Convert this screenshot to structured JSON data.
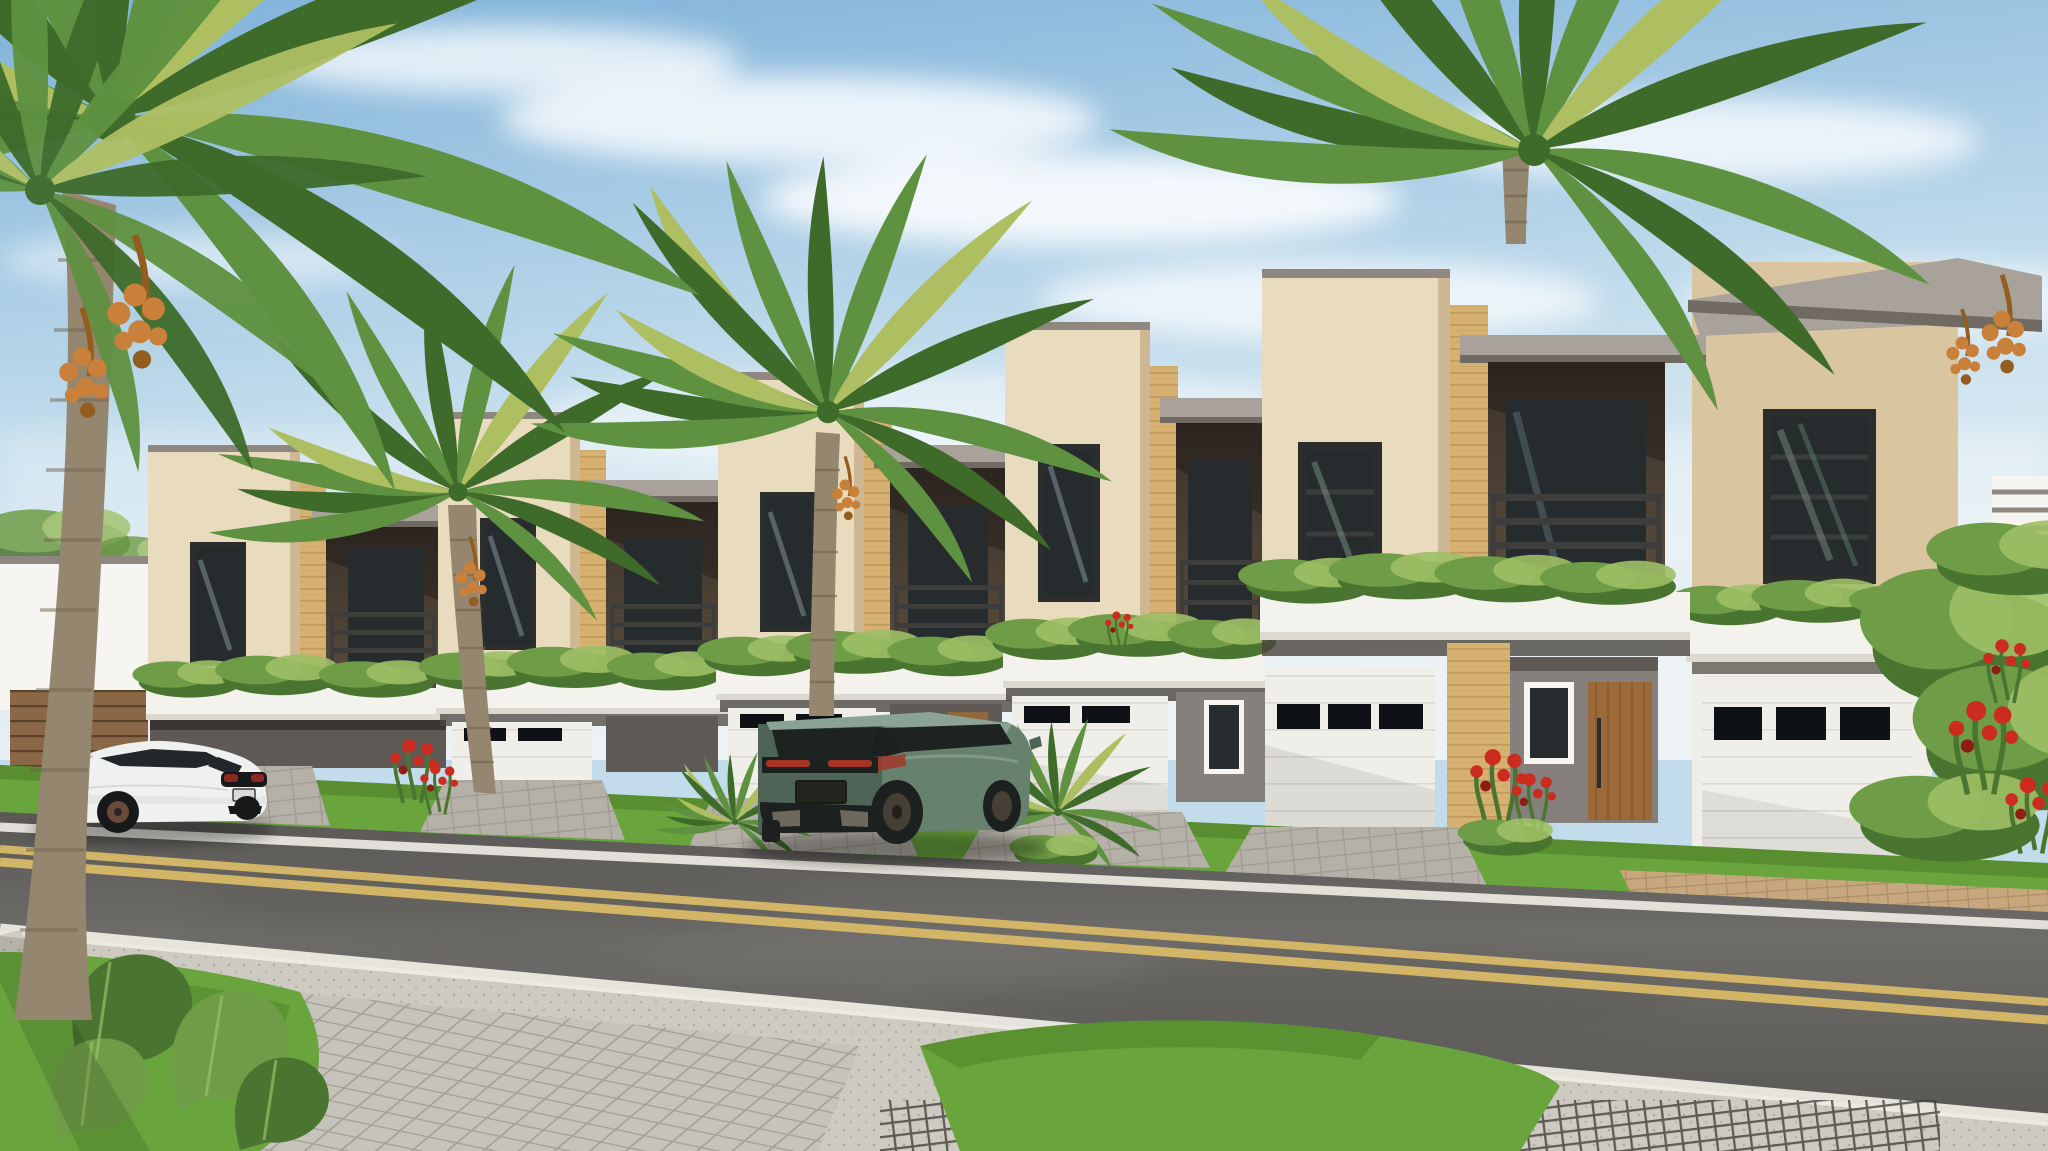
{
  "meta": {
    "kind": "architectural-rendering",
    "width_px": 2048,
    "height_px": 1151
  },
  "scene": {
    "setting": "Sunny street-level rendering of a row of modern two-story townhomes with palm trees",
    "sky": {
      "condition": "blue with wispy clouds"
    },
    "buildings": {
      "type": "modern townhomes",
      "stories": 2,
      "visible_units": 6,
      "features": [
        "flat parapet roofs with gray copings",
        "recessed balconies with dark metal railings",
        "white planter ledges with trailing plants",
        "wood-plank accent pilasters",
        "white sectional garage doors with black window slits",
        "recessed entries with wood doors",
        "front lawns and paver driveways"
      ]
    },
    "vehicles": [
      {
        "name": "white-sedan",
        "body_color_name": "white",
        "pose": "parked on street, rear three-quarter view"
      },
      {
        "name": "green-suv",
        "body_color_name": "sage green",
        "pose": "parked on driveway, rear three-quarter view"
      }
    ],
    "vegetation": [
      "date palms with orange fruit clusters",
      "balcony planter shrubs",
      "lawn strips",
      "monstera foreground plant",
      "red flowering shrubs",
      "right-side hedge with red blooms"
    ],
    "street": {
      "surface": "asphalt",
      "markings": [
        "double yellow center line",
        "white edge lines"
      ],
      "foreground": [
        "square paver sidewalk",
        "speckled concrete walk",
        "dark grid pavers",
        "grass mounds"
      ]
    }
  },
  "palette": {
    "sky_top": "#7fb2d9",
    "sky_mid": "#c2dcec",
    "sky_horizon": "#edf3f5",
    "cloud": "#ffffff",
    "wall": "#e9dbbd",
    "wall_shade": "#d9c6a1",
    "wall_dark": "#c0aa82",
    "cap": "#a8a29a",
    "cap_shade": "#8e8880",
    "cap_dark": "#6f6a62",
    "recess": "#5a4c3d",
    "recess_dark": "#3b322a",
    "glass": "#262c2e",
    "frame": "#2c2e2d",
    "railing": "#3d3d3b",
    "wood": "#d7b171",
    "wood_dark": "#af8848",
    "band": "#f4f2ec",
    "band_shade": "#ddd9d0",
    "soffit": "#4a453f",
    "plant": "#6f9c47",
    "plant_hi": "#9dc065",
    "plant_dark": "#4a7531",
    "garage": "#f0eee8",
    "garage_shade": "#d9d6cf",
    "slit": "#0e1216",
    "entry": "#85807b",
    "entry_dark": "#5f5a55",
    "door_wood": "#9c6a38",
    "door_wood_dark": "#6f4820",
    "white_trim": "#f6f5f1",
    "grass": "#69a43d",
    "grass_dark": "#4c8028",
    "drive": "#b5b1a8",
    "drive_dark": "#8f8a80",
    "drive_tan": "#c7a87e",
    "road": "#6e6c69",
    "road_dark": "#5a5855",
    "line_yellow": "#d2b567",
    "line_white": "#eeebe3",
    "walk": "#cdcac1",
    "walk_dot": "#aeaba2",
    "mesh": "#3b3934",
    "trunk": "#95866f",
    "trunk_dark": "#6e604d",
    "frond": "#5e9140",
    "frond_dark": "#3e6b2a",
    "frond_yellow": "#aebf62",
    "dates": "#c8803a",
    "dates_dark": "#935d20",
    "flower": "#cc2b20",
    "flower_dark": "#8e1d14",
    "hedge": "#567f36",
    "hedge_dark": "#3b6123",
    "car_body": "#eff1f1",
    "car_shade": "#c9cbcb",
    "car_glass": "#22272c",
    "car_trim": "#16181a",
    "car_red": "#8c2a22",
    "car_rim": "#6b4a39",
    "suv_body": "#67816f",
    "suv_shade": "#4d6457",
    "suv_hi": "#8ba394",
    "suv_glass": "#1d2321",
    "suv_trim": "#1c201e",
    "suv_red": "#a63325"
  }
}
